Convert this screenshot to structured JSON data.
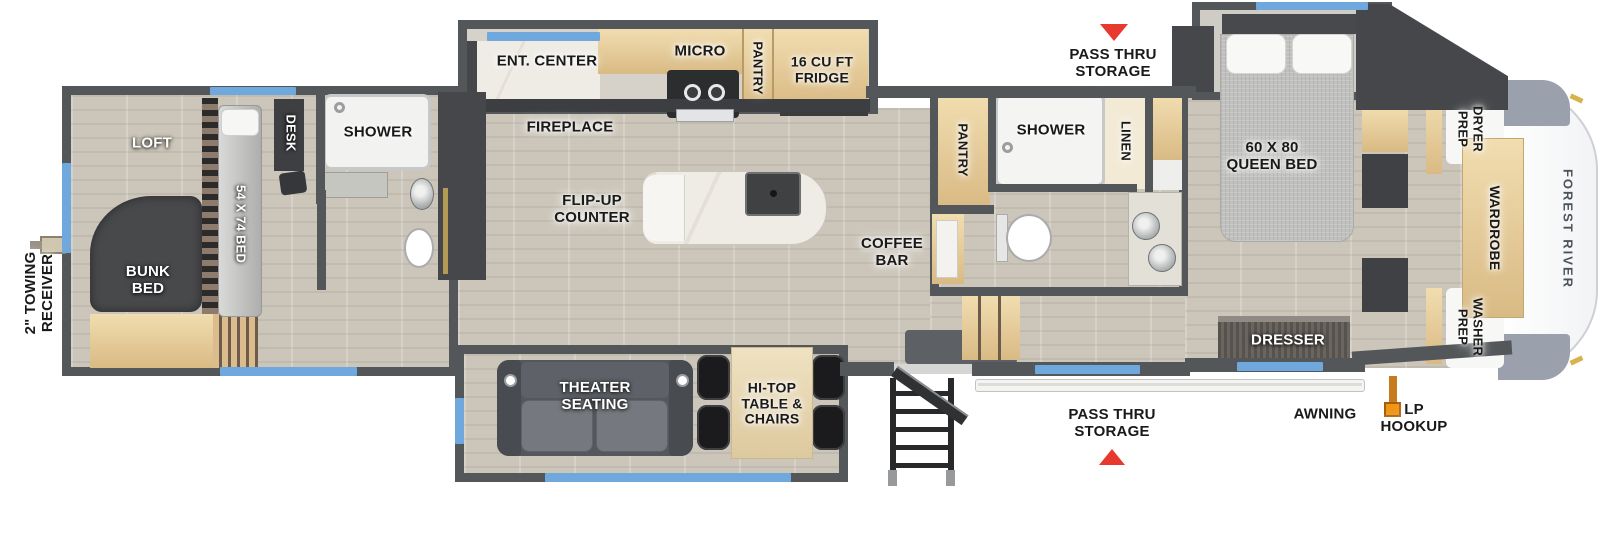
{
  "floorplan": {
    "brand": "FOREST RIVER",
    "exterior": {
      "towing": "2\" TOWING\nRECEIVER",
      "pass_thru_top": "PASS THRU\nSTORAGE",
      "pass_thru_bottom": "PASS THRU\nSTORAGE",
      "awning": "AWNING",
      "lp_hookup": "LP\nHOOKUP"
    },
    "rear_bedroom": {
      "loft": "LOFT",
      "bunk_bed": "BUNK\nBED",
      "bed": "54 X 74 BED",
      "desk": "DESK",
      "shower": "SHOWER"
    },
    "kitchen": {
      "ent_center": "ENT. CENTER",
      "fireplace": "FIREPLACE",
      "micro": "MICRO",
      "pantry": "PANTRY",
      "fridge": "16 CU FT\nFRIDGE",
      "island": "FLIP-UP\nCOUNTER",
      "coffee_bar": "COFFEE\nBAR"
    },
    "living": {
      "theater": "THEATER\nSEATING",
      "hitop": "HI-TOP\nTABLE &\nCHAIRS"
    },
    "mid_bath": {
      "pantry": "PANTRY",
      "shower": "SHOWER",
      "linen": "LINEN"
    },
    "front_bedroom": {
      "queen_bed": "60 X 80\nQUEEN BED",
      "dresser": "DRESSER",
      "wardrobe": "WARDROBE",
      "dryer_prep": "DRYER\nPREP",
      "washer_prep": "WASHER\nPREP"
    },
    "palette": {
      "wall": "#54575a",
      "floor": "#cbc5b9",
      "carpet": "#97867a",
      "counter": "#e7cd9b",
      "window_accent": "#6fa8dc",
      "arrow_red": "#e8392e",
      "lp_orange": "#ef9613"
    }
  }
}
